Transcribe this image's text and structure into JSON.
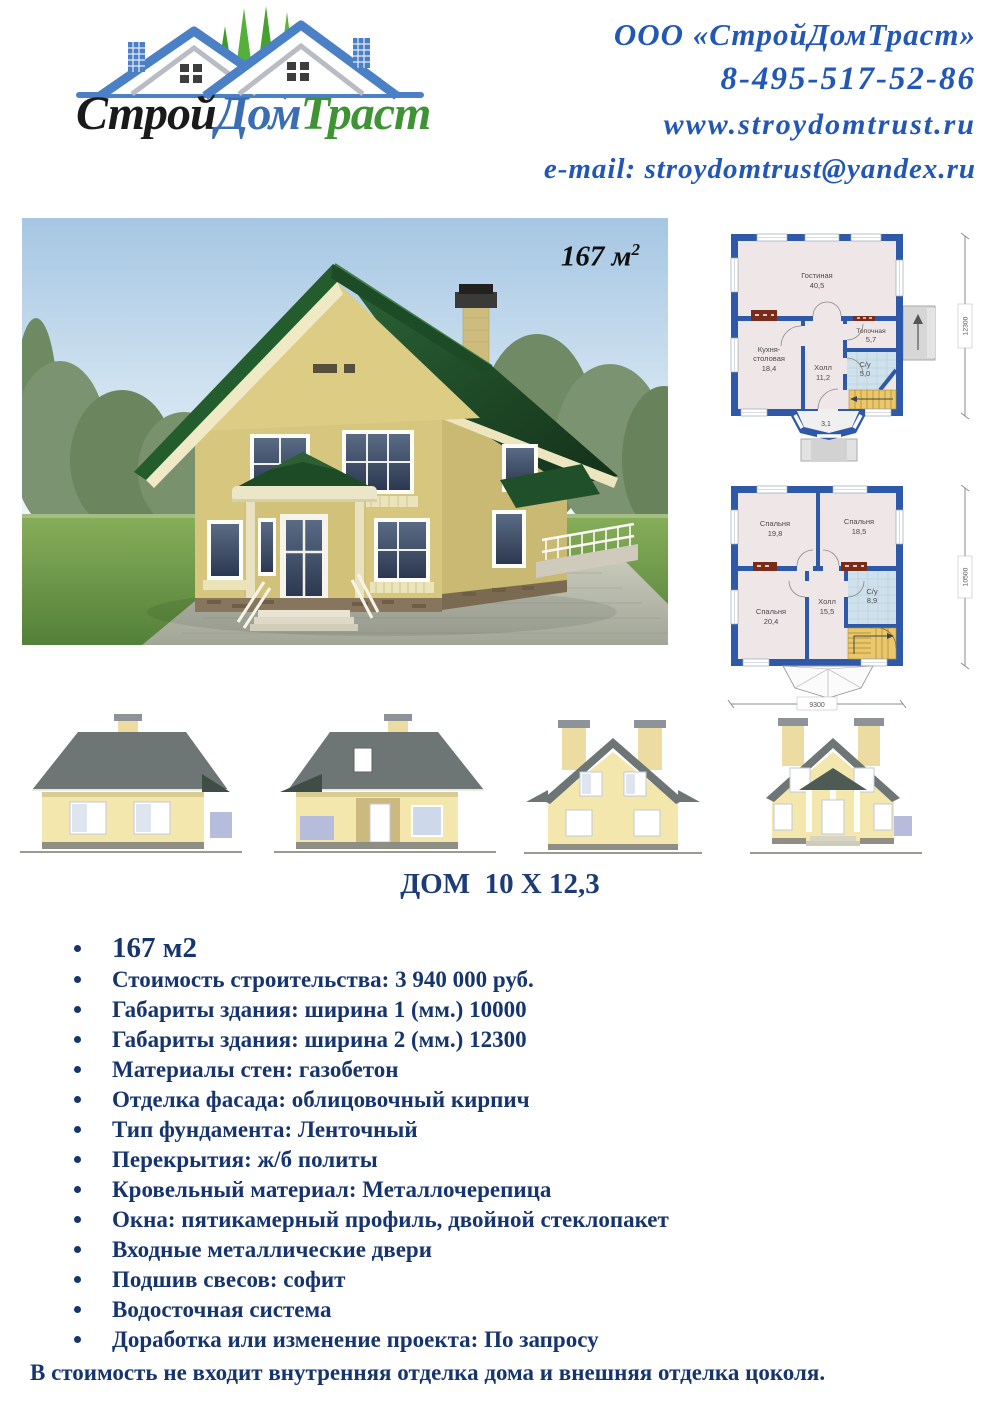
{
  "header": {
    "logo_text": {
      "part1": "Строй",
      "part2": "Дом",
      "part3": "Траст"
    },
    "contacts": {
      "company": "ООО «СтройДомТраст»",
      "phone": "8-495-517-52-86",
      "website": "www.stroydomtrust.ru",
      "email": "e-mail: stroydomtrust@yandex.ru"
    }
  },
  "render": {
    "area_value": "167 м",
    "area_sup": "2"
  },
  "plans": {
    "floor1": {
      "rooms": {
        "living": {
          "name": "Гостиная",
          "area": "40,5"
        },
        "kitchen": {
          "name": "Кухня-",
          "name2": "столовая",
          "area": "18,4"
        },
        "boiler": {
          "name": "Топочная",
          "area": "5,7"
        },
        "wc": {
          "name": "С/у",
          "area": "5,0"
        },
        "hall": {
          "name": "Холл",
          "area": "11,2"
        },
        "vestibule": {
          "area": "3,1"
        }
      },
      "dim_height": "12300"
    },
    "floor2": {
      "rooms": {
        "bedroom1": {
          "name": "Спальня",
          "area": "19,8"
        },
        "bedroom2": {
          "name": "Спальня",
          "area": "18,5"
        },
        "bedroom3": {
          "name": "Спальня",
          "area": "20,4"
        },
        "hall": {
          "name": "Холл",
          "area": "15,5"
        },
        "wc": {
          "name": "С/у",
          "area": "8,9"
        }
      },
      "dim_height": "10500",
      "dim_width": "9300"
    }
  },
  "section_title": "ДОМ  10 Х 12,3",
  "specs": [
    "167 м2",
    "Стоимость строительства: 3 940 000 руб.",
    "Габариты здания: ширина 1 (мм.) 10000",
    "Габариты здания: ширина 2 (мм.) 12300",
    "Материалы стен: газобетон",
    "Отделка фасада: облицовочный кирпич",
    "Тип фундамента: Ленточный",
    "Перекрытия: ж/б политы",
    "Кровельный материал: Металлочерепица",
    "Окна: пятикамерный профиль, двойной стеклопакет",
    "Входные металлические двери",
    "Подшив свесов: софит",
    "Водосточная система",
    "Доработка или изменение проекта: По запросу"
  ],
  "footer_note": "В стоимость не входит внутренняя отделка дома и внешняя отделка цоколя.",
  "colors": {
    "accent_blue": "#2257b5",
    "navy_text": "#16356f",
    "plan_wall_blue": "#2d59a8",
    "roof_green": "#1e4f28",
    "logo_roof_blue": "#4b80c6",
    "logo_green": "#3f9334"
  }
}
